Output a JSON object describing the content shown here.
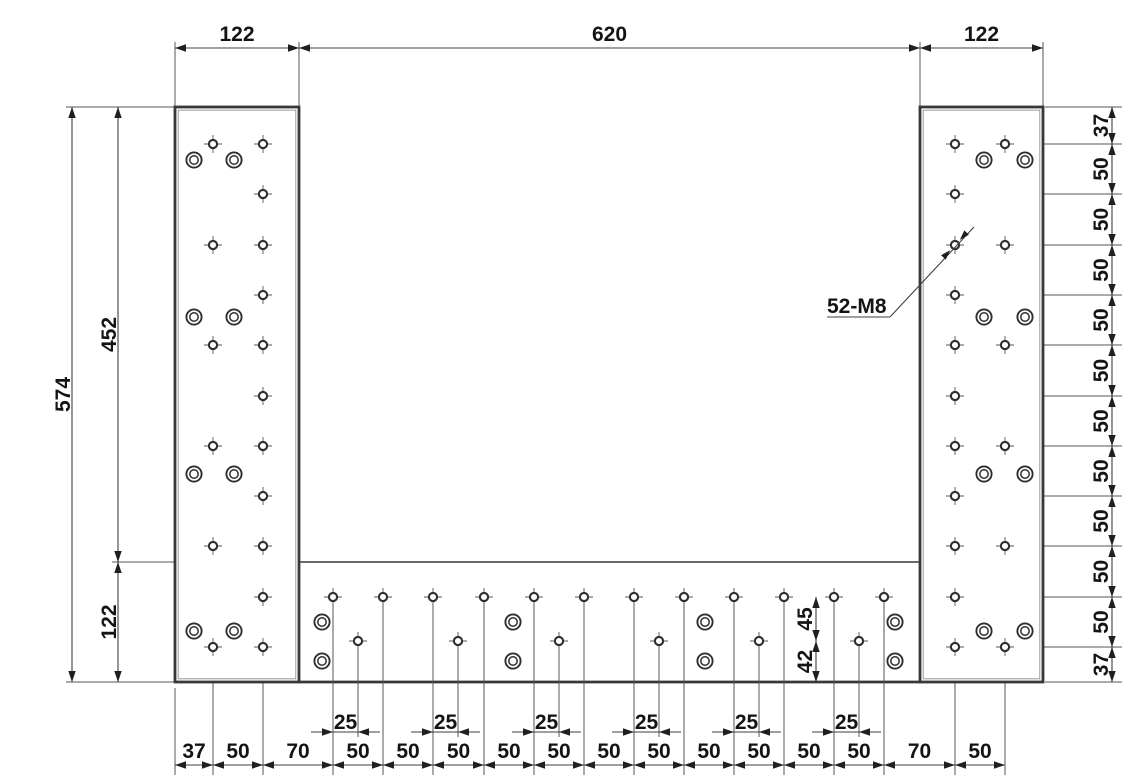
{
  "colors": {
    "background": "#ffffff",
    "outline": "#383838",
    "edge_highlight": "#9a9a9a",
    "thin_line": "#555555",
    "dim_line": "#3f3f3f",
    "arrow": "#1f1f1f",
    "text": "#141414",
    "hole_ring": "#2f2f2f"
  },
  "callout": {
    "label": "52-M8"
  },
  "dimensions": {
    "top": {
      "labels": [
        "122",
        "620",
        "122"
      ]
    },
    "left": {
      "overall": "574",
      "upper": "452",
      "lower": "122"
    },
    "right": {
      "labels": [
        "37",
        "50",
        "50",
        "50",
        "50",
        "50",
        "50",
        "50",
        "50",
        "50",
        "50",
        "37"
      ]
    },
    "bottom": {
      "labels": [
        "37",
        "50",
        "70",
        "50",
        "50",
        "50",
        "50",
        "50",
        "50",
        "50",
        "50",
        "50",
        "50",
        "50",
        "70",
        "50"
      ]
    },
    "bottom_offsets": {
      "labels": [
        "25",
        "25",
        "25",
        "25",
        "25",
        "25"
      ]
    },
    "middle": {
      "labels": [
        "45",
        "42"
      ]
    }
  },
  "geometry": {
    "canvas": {
      "width": 1147,
      "height": 783
    },
    "left_column": {
      "x1": 175,
      "y1": 107,
      "x2": 299,
      "y2": 682
    },
    "right_column": {
      "x1": 920,
      "y1": 107,
      "x2": 1043,
      "y2": 682
    },
    "bottom_plate": {
      "x1": 299,
      "y1": 562,
      "x2": 920,
      "y2": 682
    },
    "hole_rows_y": [
      144,
      194,
      245,
      295,
      345,
      396,
      446,
      496,
      546,
      597,
      647
    ],
    "left_cross_cols": [
      213,
      263
    ],
    "right_cross_cols": [
      955,
      1005
    ],
    "left_cbore_cols": [
      194,
      234
    ],
    "right_cbore_cols": [
      984,
      1025
    ],
    "cbore_rows_y": [
      160,
      317,
      474,
      631
    ],
    "plate_top_row": {
      "y": 597,
      "xs": [
        333,
        383,
        433,
        484,
        534,
        584,
        634,
        684,
        734,
        784,
        834,
        884
      ]
    },
    "plate_low_row": {
      "y": 641,
      "offset": 25,
      "from_top_idx": [
        0,
        2,
        4,
        6,
        8,
        10
      ]
    },
    "plate_cbore": {
      "xs": [
        322,
        513,
        705,
        895
      ],
      "ys": [
        622,
        661
      ]
    },
    "chains": {
      "top": {
        "y": 48,
        "boundaries": [
          175,
          299,
          920,
          1043
        ],
        "label_y": 41
      },
      "left_outer": {
        "x": 72,
        "boundaries": [
          107,
          682
        ],
        "label_x": 70
      },
      "left_inner": {
        "x": 118,
        "boundaries": [
          107,
          562,
          682
        ],
        "label_x": 116
      },
      "right": {
        "x": 1112,
        "boundaries": [
          107,
          144,
          194,
          245,
          295,
          345,
          396,
          446,
          496,
          546,
          597,
          647,
          682
        ],
        "label_x": 1108
      },
      "bottom": {
        "y": 765,
        "boundaries": [
          175,
          213,
          263,
          333,
          383,
          433,
          484,
          534,
          584,
          634,
          684,
          734,
          784,
          834,
          884,
          955,
          1005
        ],
        "label_y": 758
      },
      "middle": {
        "x": 816,
        "boundaries": [
          597,
          641,
          682
        ],
        "label_x": 812
      },
      "offset25": {
        "y": 732,
        "label_y": 729
      }
    },
    "callout_geom": {
      "text_x": 827,
      "text_y": 313,
      "underline": [
        827,
        317,
        890,
        317
      ],
      "leader": [
        890,
        317,
        974,
        227
      ],
      "target": [
        955,
        245
      ]
    }
  }
}
